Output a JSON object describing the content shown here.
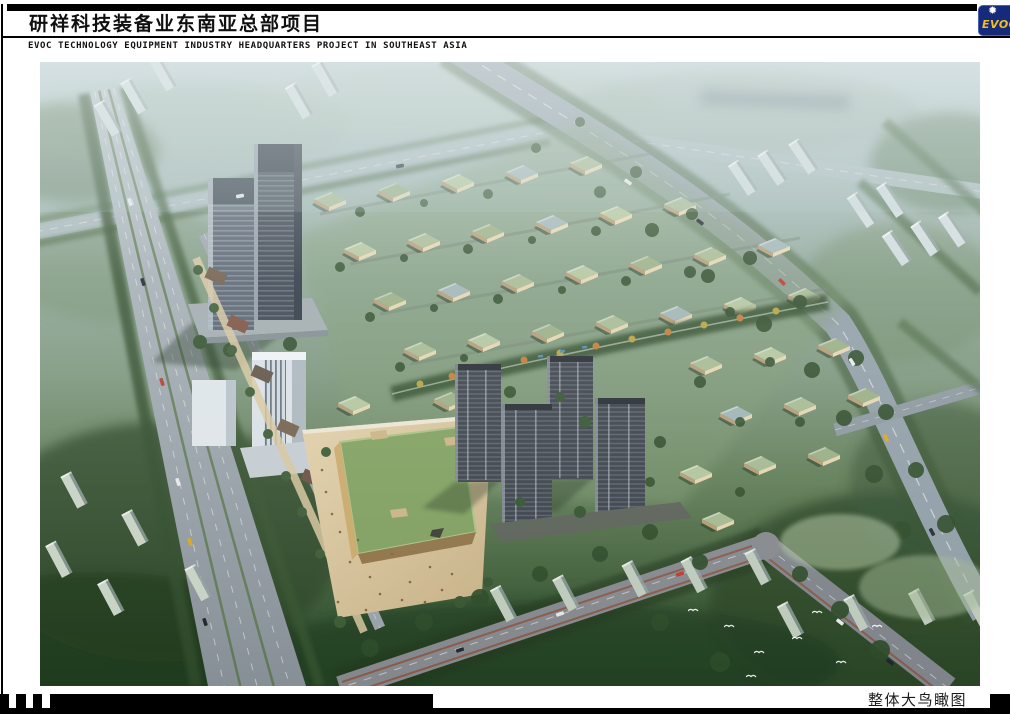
{
  "header": {
    "title": "研祥科技装备业东南亚总部项目",
    "subtitle": "EVOC TECHNOLOGY EQUIPMENT INDUSTRY HEADQUARTERS PROJECT IN SOUTHEAST ASIA",
    "logo": {
      "text": "EVOC",
      "star_icon": "starburst"
    }
  },
  "footer": {
    "caption": "整体大鸟瞰图"
  },
  "palette": {
    "page_bg": "#ffffff",
    "ink": "#000000",
    "logo_bg": "#162a7c",
    "logo_accent": "#f3c01c",
    "logo_star": "#ffffff",
    "caption_ink": "#1a1a1a",
    "haze_top": "#b7c9cd",
    "tree_dark": "#2c4a28",
    "villa_roof_green": "#9fb38d",
    "villa_wall_tan": "#e2d4ae",
    "road_gray": "#96a3aa",
    "tower_dark": "#39434f",
    "plaza_sand": "#d8c7a0",
    "mall_green_roof": "#7f9f5f"
  }
}
